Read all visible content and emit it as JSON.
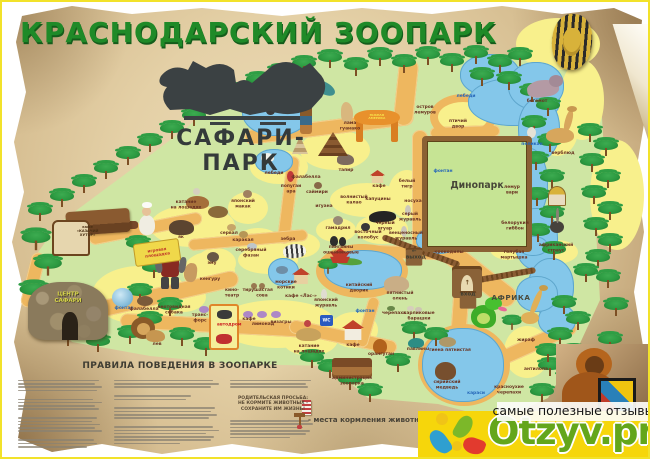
{
  "title": "КРАСНОДАРСКИЙ ЗООПАРК",
  "logo": {
    "text": "САФАРИ-ПАРК"
  },
  "map": {
    "zones": {
      "dinopark": "Динопарк",
      "africa": "АФРИКА",
      "south_america": "ЮЖНАЯ\nАМЕРИКА",
      "safari_center": "ЦЕНТР\nСАФАРИ",
      "entrance": "вход",
      "exit": "← выход",
      "playground": "игровая\nплощадка",
      "avtodrom": "автодром",
      "wc": "WC",
      "kazachy_cafe": "кафе\n«КАЗАЧИЙ\nХУТОР»",
      "entrance_arrow": "↑"
    },
    "pois": [
      {
        "t": "лебеди",
        "x": 466,
        "y": 94,
        "c": "blue"
      },
      {
        "t": "остров\nлемуров",
        "x": 425,
        "y": 105
      },
      {
        "t": "бегемот",
        "x": 537,
        "y": 99
      },
      {
        "t": "птичий\nдвор",
        "x": 458,
        "y": 119
      },
      {
        "t": "пеликан",
        "x": 532,
        "y": 142,
        "c": "blue"
      },
      {
        "t": "верблюд",
        "x": 563,
        "y": 151
      },
      {
        "t": "лама\nгуанако",
        "x": 350,
        "y": 121
      },
      {
        "t": "лебеди",
        "x": 274,
        "y": 171
      },
      {
        "t": "фалабелла",
        "x": 306,
        "y": 175
      },
      {
        "t": "тапир",
        "x": 346,
        "y": 168
      },
      {
        "t": "кафе",
        "x": 379,
        "y": 184
      },
      {
        "t": "белый\nтигр",
        "x": 407,
        "y": 179
      },
      {
        "t": "попугаи\nара",
        "x": 291,
        "y": 184
      },
      {
        "t": "саймири",
        "x": 317,
        "y": 190
      },
      {
        "t": "игуана",
        "x": 324,
        "y": 204
      },
      {
        "t": "волнистый\nкалао",
        "x": 354,
        "y": 195
      },
      {
        "t": "капуцины",
        "x": 378,
        "y": 197
      },
      {
        "t": "гамадрил",
        "x": 338,
        "y": 226
      },
      {
        "t": "чёрный\nягуар",
        "x": 385,
        "y": 221
      },
      {
        "t": "восточный\nколобус",
        "x": 368,
        "y": 230
      },
      {
        "t": "носуха",
        "x": 413,
        "y": 199
      },
      {
        "t": "серый\nжуравль",
        "x": 410,
        "y": 212
      },
      {
        "t": "венценосный\nжуравль",
        "x": 406,
        "y": 231
      },
      {
        "t": "японский\nмакак",
        "x": 243,
        "y": 199
      },
      {
        "t": "фонтан",
        "x": 443,
        "y": 169,
        "c": "blue"
      },
      {
        "t": "лемур\nвари",
        "x": 512,
        "y": 185
      },
      {
        "t": "белорукий\nгиббон",
        "x": 515,
        "y": 221
      },
      {
        "t": "сервал",
        "x": 229,
        "y": 231
      },
      {
        "t": "каракал",
        "x": 243,
        "y": 238
      },
      {
        "t": "серебряный\nфазан",
        "x": 251,
        "y": 248
      },
      {
        "t": "зебра",
        "x": 288,
        "y": 237
      },
      {
        "t": "эму",
        "x": 212,
        "y": 261
      },
      {
        "t": "як",
        "x": 181,
        "y": 235
      },
      {
        "t": "катание\nна лошадях",
        "x": 186,
        "y": 200
      },
      {
        "t": "кенгуру",
        "x": 210,
        "y": 277
      },
      {
        "t": "кино-\nтеатр",
        "x": 232,
        "y": 288
      },
      {
        "t": "тир",
        "x": 247,
        "y": 288
      },
      {
        "t": "ушастая\nсова",
        "x": 262,
        "y": 288
      },
      {
        "t": "морские\nкотики",
        "x": 286,
        "y": 280
      },
      {
        "t": "кафе «Лас-»",
        "x": 301,
        "y": 294
      },
      {
        "t": "пингвины\nошейниковые",
        "x": 341,
        "y": 245
      },
      {
        "t": "японский\nжуравль",
        "x": 326,
        "y": 298
      },
      {
        "t": "крокодилы",
        "x": 449,
        "y": 250
      },
      {
        "t": "голубая\nмартышка",
        "x": 514,
        "y": 250
      },
      {
        "t": "африканский\nстраус",
        "x": 556,
        "y": 243
      },
      {
        "t": "жираф",
        "x": 526,
        "y": 338
      },
      {
        "t": "антилопа",
        "x": 536,
        "y": 367
      },
      {
        "t": "пятнистый\nолень",
        "x": 400,
        "y": 291
      },
      {
        "t": "черепаха",
        "x": 394,
        "y": 311
      },
      {
        "t": "карликовые\nбарашки",
        "x": 419,
        "y": 311
      },
      {
        "t": "китайский\nдворик",
        "x": 359,
        "y": 283
      },
      {
        "t": "фонтан",
        "x": 365,
        "y": 309,
        "c": "blue"
      },
      {
        "t": "павлины",
        "x": 418,
        "y": 347
      },
      {
        "t": "гиена пятнистая",
        "x": 450,
        "y": 348
      },
      {
        "t": "сирийский\nмедведь",
        "x": 447,
        "y": 380
      },
      {
        "t": "караси",
        "x": 476,
        "y": 391,
        "c": "blue"
      },
      {
        "t": "красноухие\nчерепахи",
        "x": 509,
        "y": 385
      },
      {
        "t": "администрация\nзоопарка",
        "x": 352,
        "y": 376
      },
      {
        "t": "кафе",
        "x": 353,
        "y": 343
      },
      {
        "t": "орангутан",
        "x": 381,
        "y": 352
      },
      {
        "t": "лев",
        "x": 157,
        "y": 342
      },
      {
        "t": "фонтан",
        "x": 124,
        "y": 306,
        "c": "blue"
      },
      {
        "t": "фалабелла",
        "x": 144,
        "y": 307
      },
      {
        "t": "енотовидная\nсобака",
        "x": 174,
        "y": 305
      },
      {
        "t": "транс-\nфорс",
        "x": 200,
        "y": 313
      },
      {
        "t": "кафе",
        "x": 249,
        "y": 317
      },
      {
        "t": "лимонад",
        "x": 263,
        "y": 322
      },
      {
        "t": "визагры",
        "x": 281,
        "y": 320
      },
      {
        "t": "катание\nна лошадях",
        "x": 309,
        "y": 344
      },
      {
        "t": "Динопарк",
        "x": 477,
        "y": 180,
        "c": "zone-big"
      },
      {
        "t": "АФРИКА",
        "x": 511,
        "y": 294,
        "c": "zone"
      },
      {
        "t": "вход",
        "x": 468,
        "y": 291,
        "c": "gate"
      },
      {
        "t": "← выход",
        "x": 414,
        "y": 248,
        "c": "gate"
      }
    ]
  },
  "rules": {
    "heading": "ПРАВИЛА ПОВЕДЕНИЯ В ЗООПАРКЕ",
    "parent_note": "РОДИТЕЛЬСКАЯ ПРОСЬБА:\nНЕ КОРМИТЕ ЖИВОТНЫХ -\nСОХРАНИТЕ ИМ ЖИЗНЬ!"
  },
  "legend": {
    "feeding_label": "- места кормления животных"
  },
  "footer": {
    "tagline": "самые полезные отзывы",
    "brand": "Otzyv.pro"
  },
  "colors": {
    "accent_green": "#1f8a28",
    "brand_green": "#64a61b",
    "brand_yellow": "#f6d60b",
    "paper": "#e4d0a6"
  }
}
